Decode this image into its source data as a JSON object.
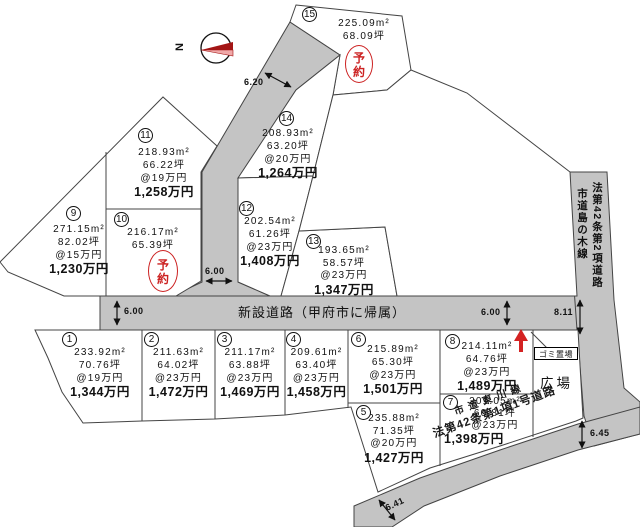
{
  "compass": {
    "north": "N"
  },
  "roads": {
    "new_road": "新設道路（甲府市に帰属）",
    "right_road_name": "市道島の木線",
    "right_road_class": "法第42条第2項道路",
    "bottom_road_name": "市道東川線",
    "bottom_road_class": "法第42条第1項1号道路"
  },
  "labels": {
    "garbage": "ゴミ置場",
    "plaza": "広場",
    "reserved": "予約"
  },
  "measurements": {
    "top_road": "6.20",
    "left_road": "6.00",
    "mid_road": "6.00",
    "right_road": "6.00",
    "junction": "8.11",
    "bottom_left": "6.41",
    "bottom_right": "6.45"
  },
  "plots": [
    {
      "num": "1",
      "area": "233.92m²",
      "tsubo": "70.76坪",
      "unit": "@19万円",
      "price": "1,344万円"
    },
    {
      "num": "2",
      "area": "211.63m²",
      "tsubo": "64.02坪",
      "unit": "@23万円",
      "price": "1,472万円"
    },
    {
      "num": "3",
      "area": "211.17m²",
      "tsubo": "63.88坪",
      "unit": "@23万円",
      "price": "1,469万円"
    },
    {
      "num": "4",
      "area": "209.61m²",
      "tsubo": "63.40坪",
      "unit": "@23万円",
      "price": "1,458万円"
    },
    {
      "num": "5",
      "area": "235.88m²",
      "tsubo": "71.35坪",
      "unit": "@20万円",
      "price": "1,427万円"
    },
    {
      "num": "6",
      "area": "215.89m²",
      "tsubo": "65.30坪",
      "unit": "@23万円",
      "price": "1,501万円"
    },
    {
      "num": "7",
      "area": "201.05m²",
      "tsubo": "60.81坪",
      "unit": "@23万円",
      "price": "1,398万円"
    },
    {
      "num": "8",
      "area": "214.11m²",
      "tsubo": "64.76坪",
      "unit": "@23万円",
      "price": "1,489万円"
    },
    {
      "num": "9",
      "area": "271.15m²",
      "tsubo": "82.02坪",
      "unit": "@15万円",
      "price": "1,230万円"
    },
    {
      "num": "10",
      "area": "216.17m²",
      "tsubo": "65.39坪",
      "reserved": true
    },
    {
      "num": "11",
      "area": "218.93m²",
      "tsubo": "66.22坪",
      "unit": "@19万円",
      "price": "1,258万円"
    },
    {
      "num": "12",
      "area": "202.54m²",
      "tsubo": "61.26坪",
      "unit": "@23万円",
      "price": "1,408万円"
    },
    {
      "num": "13",
      "area": "193.65m²",
      "tsubo": "58.57坪",
      "unit": "@23万円",
      "price": "1,347万円"
    },
    {
      "num": "14",
      "area": "208.93m²",
      "tsubo": "63.20坪",
      "unit": "@20万円",
      "price": "1,264万円"
    },
    {
      "num": "15",
      "area": "225.09m²",
      "tsubo": "68.09坪",
      "reserved": true
    }
  ]
}
